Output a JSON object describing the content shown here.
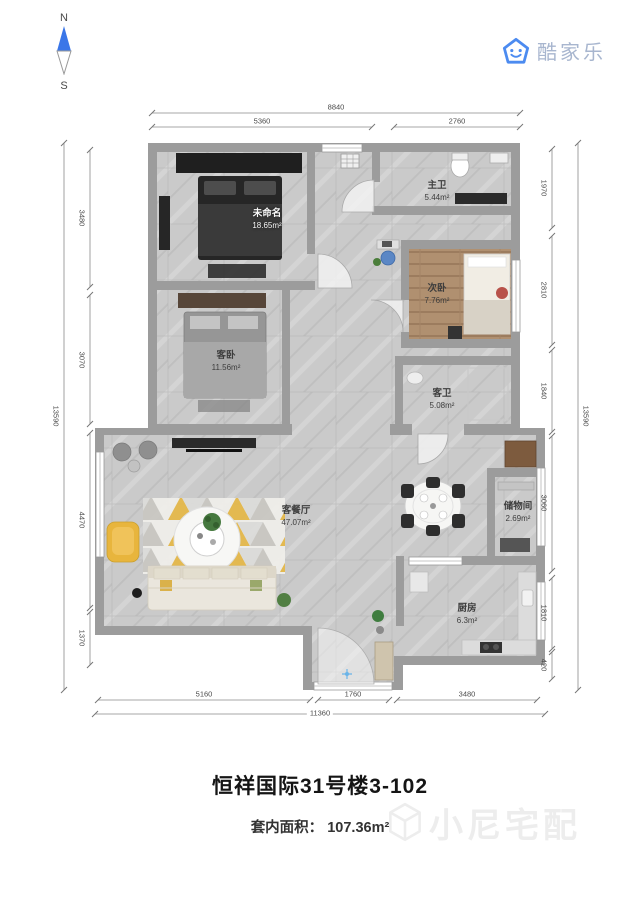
{
  "compass": {
    "north": "N",
    "south": "S"
  },
  "logo": {
    "text": "酷家乐"
  },
  "rooms": [
    {
      "name": "未命名",
      "area": "18.65m²"
    },
    {
      "name": "主卫",
      "area": "5.44m²"
    },
    {
      "name": "次卧",
      "area": "7.76m²"
    },
    {
      "name": "客卧",
      "area": "11.56m²"
    },
    {
      "name": "客卫",
      "area": "5.08m²"
    },
    {
      "name": "客餐厅",
      "area": "47.07m²"
    },
    {
      "name": "储物间",
      "area": "2.69m²"
    },
    {
      "name": "厨房",
      "area": "6.3m²"
    }
  ],
  "dimensions": {
    "top": {
      "outer": "8840",
      "inner": [
        "5360",
        "2760"
      ]
    },
    "bottom": {
      "outer": "11360",
      "inner": [
        "5160",
        "1760",
        "3480"
      ]
    },
    "left": {
      "outer": "13590",
      "inner": [
        "3480",
        "3070",
        "4470",
        "1370"
      ]
    },
    "right": {
      "outer": "13590",
      "inner": [
        "1970",
        "2810",
        "1840",
        "3060",
        "1810",
        "420"
      ]
    }
  },
  "footer": {
    "title": "恒祥国际31号楼3-102",
    "area_label": "套内面积：",
    "area_value": "107.36m²",
    "watermark": "小尼宅配"
  },
  "colors": {
    "wall": "#9c9c9c",
    "floor": "#cacaca",
    "brand_blue": "#4c8bf0",
    "accent_yellow": "#e6b53f",
    "title_text": "#151515",
    "watermark_gray": "#ededed"
  }
}
